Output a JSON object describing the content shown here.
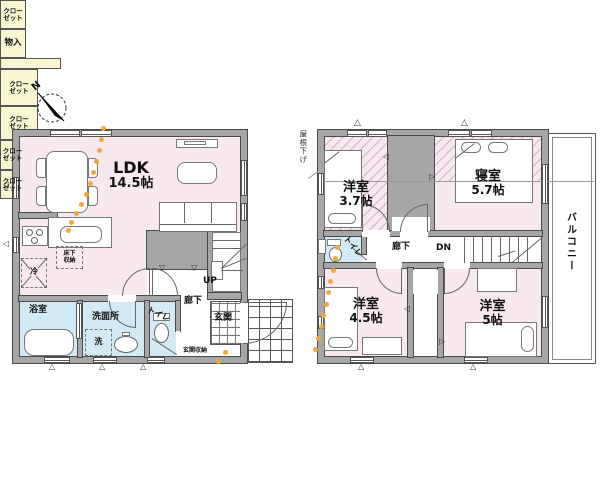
{
  "colors": {
    "room_pink": "#f8e8f0",
    "water_blue": "#d2eaf4",
    "storage_yellow": "#f8f5d3",
    "wall_gray": "#a6a6a6",
    "flow_orange": "#f0a73e"
  },
  "compass": {
    "north": "N"
  },
  "floor1": {
    "ldk": {
      "name": "LDK",
      "size": "14.5帖"
    },
    "bathroom": "浴室",
    "washroom": "洗面所",
    "toilet": "トイレ",
    "hallway": "廊下",
    "entrance": "玄関",
    "entrance_storage": "玄関収納",
    "stairs": "UP",
    "closet_l1": "クロー",
    "closet_l2": "ゼット",
    "storage": "物入",
    "underfloor_l1": "床下",
    "underfloor_l2": "収納",
    "fridge": "冷",
    "washer": "洗"
  },
  "floor2": {
    "room_nw": {
      "name": "洋室",
      "size": "3.7帖"
    },
    "bedroom": {
      "name": "寝室",
      "size": "5.7帖"
    },
    "room_sw": {
      "name": "洋室",
      "size": "4.5帖"
    },
    "room_se": {
      "name": "洋室",
      "size": "5帖"
    },
    "toilet": "トイレ",
    "hallway": "廊下",
    "stairs": "DN",
    "balcony": "バルコニー",
    "roof_note": "屋根下げ",
    "closet_l1": "クロー",
    "closet_l2": "ゼット"
  },
  "flow_dots": {
    "f1": [
      [
        103,
        128
      ],
      [
        101,
        139
      ],
      [
        99,
        150
      ],
      [
        96,
        161
      ],
      [
        93,
        172
      ],
      [
        90,
        183
      ],
      [
        86,
        194
      ],
      [
        81,
        204
      ],
      [
        76,
        213
      ],
      [
        71,
        222
      ],
      [
        68,
        230
      ]
    ],
    "entrance": [
      [
        225,
        352
      ],
      [
        218,
        361
      ]
    ],
    "f2": [
      [
        337,
        247
      ],
      [
        335,
        258
      ],
      [
        333,
        270
      ],
      [
        330,
        281
      ],
      [
        328,
        292
      ],
      [
        326,
        304
      ],
      [
        323,
        315
      ],
      [
        321,
        326
      ],
      [
        318,
        338
      ],
      [
        315,
        349
      ]
    ]
  }
}
